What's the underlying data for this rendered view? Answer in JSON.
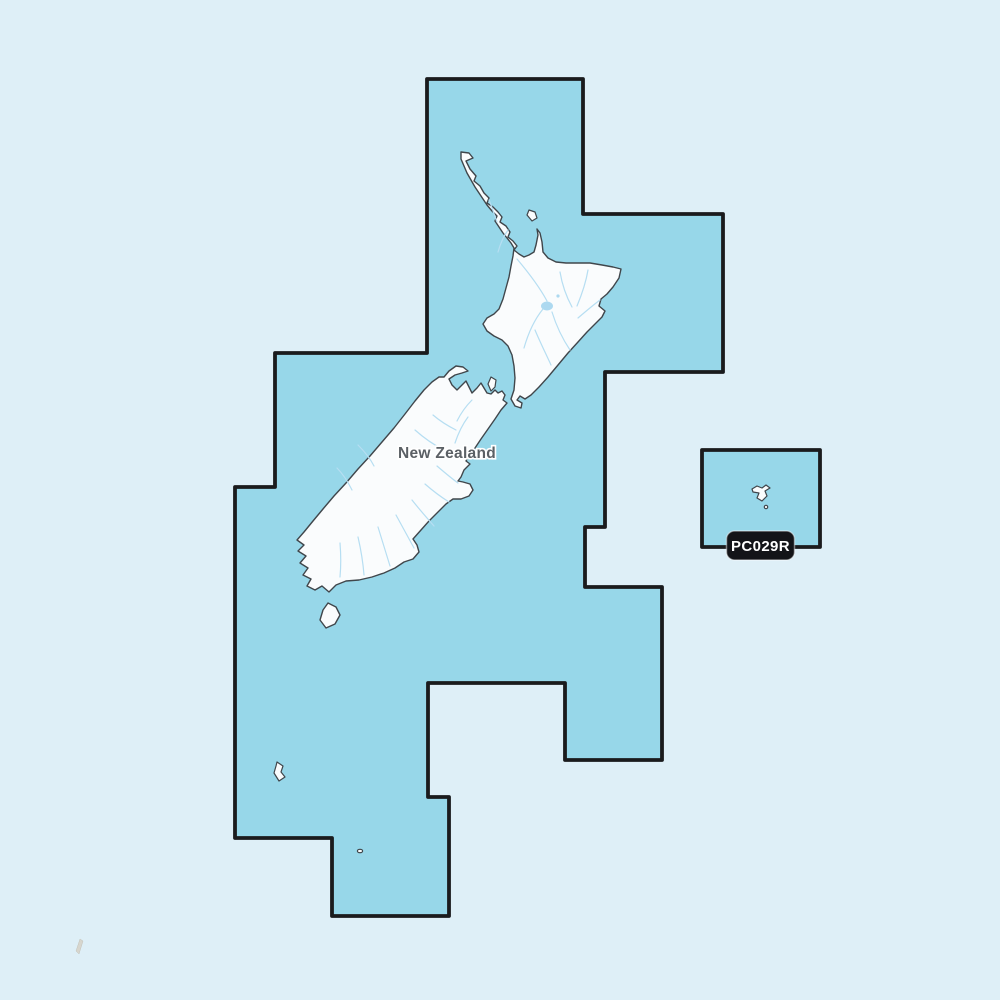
{
  "map": {
    "country_label": "New Zealand",
    "chart_code_badge": "PC029R",
    "colors": {
      "background": "#deeff7",
      "coverage_fill": "#97d7e9",
      "coverage_outline": "#1a1b1d",
      "land_fill": "#fafcfd",
      "land_outline": "#40464b",
      "river": "#b6def2",
      "lake": "#add9f0",
      "country_label_text": "#5b6065",
      "badge_background": "#131418",
      "badge_text": "#ffffff"
    }
  }
}
